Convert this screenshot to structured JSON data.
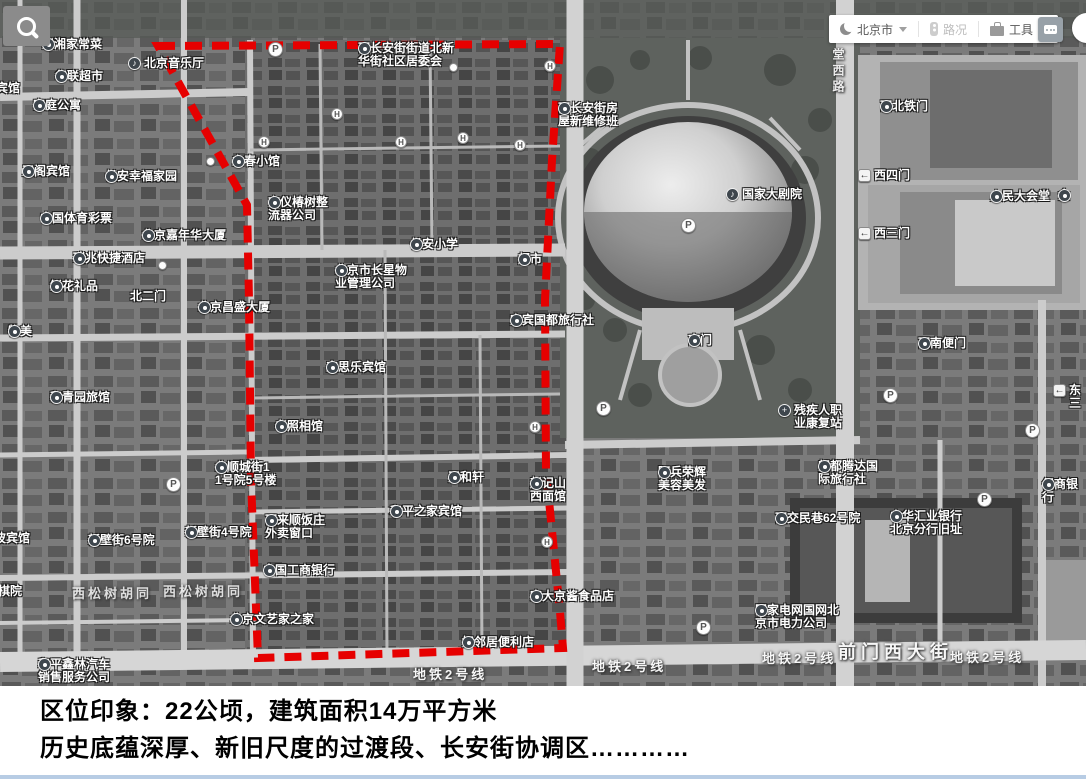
{
  "toolbar": {
    "city": "北京市",
    "traffic_label": "路况",
    "tools_label": "工具"
  },
  "caption": {
    "line1": "区位印象：22公顷，建筑面积14万平方米",
    "line2": "历史底蕴深厚、新旧尺度的过渡段、长安街协调区…………"
  },
  "map": {
    "boundary_color": "#e60000",
    "poi_labels": [
      {
        "text": "川湘家常菜",
        "x": 42,
        "y": 38,
        "icon": "poi"
      },
      {
        "text": "北京音乐厅",
        "x": 128,
        "y": 57,
        "icon": "music"
      },
      {
        "text": "华联超市",
        "x": 55,
        "y": 70,
        "icon": "poi"
      },
      {
        "text": "苑宾馆",
        "x": -16,
        "y": 82,
        "icon": "poi"
      },
      {
        "text": "家庭公寓",
        "x": 33,
        "y": 99,
        "icon": "poi"
      },
      {
        "text": "玉阁宾馆",
        "x": 22,
        "y": 165,
        "icon": "poi"
      },
      {
        "text": "长安幸福家园",
        "x": 105,
        "y": 170,
        "icon": "poi"
      },
      {
        "text": "中国体育彩票",
        "x": 40,
        "y": 212,
        "icon": "poi"
      },
      {
        "text": "北京嘉年华大厦",
        "x": 142,
        "y": 229,
        "icon": "poi"
      },
      {
        "text": "瑞兆快捷酒店",
        "x": 73,
        "y": 252,
        "icon": "poi"
      },
      {
        "text": "鲜花礼品",
        "x": 50,
        "y": 280,
        "icon": "poi"
      },
      {
        "text": "北二门",
        "x": 130,
        "y": 290,
        "icon": "none"
      },
      {
        "text": "北京昌盛大厦",
        "x": 198,
        "y": 301,
        "icon": "poi"
      },
      {
        "text": "物美",
        "x": 8,
        "y": 325,
        "icon": "poi"
      },
      {
        "text": "和青园旅馆",
        "x": 50,
        "y": 391,
        "icon": "poi"
      },
      {
        "text": "北顺城街1\n1号院5号楼",
        "x": 215,
        "y": 461,
        "icon": "poi"
      },
      {
        "text": "宁波宾馆",
        "x": -18,
        "y": 532,
        "icon": "none"
      },
      {
        "text": "新壁街6号院",
        "x": 88,
        "y": 534,
        "icon": "poi"
      },
      {
        "text": "新壁街4号院",
        "x": 185,
        "y": 526,
        "icon": "poi"
      },
      {
        "text": "京棋院",
        "x": -14,
        "y": 585,
        "icon": "none"
      },
      {
        "text": "和平鑫林汽车\n销售服务公司",
        "x": 38,
        "y": 658,
        "icon": "poi"
      },
      {
        "text": "西长安街街道北新\n华街社区居委会",
        "x": 358,
        "y": 42,
        "icon": "poi"
      },
      {
        "text": "立春小馆",
        "x": 232,
        "y": 155,
        "icon": "poi"
      },
      {
        "text": "京仪椿树整\n流器公司",
        "x": 268,
        "y": 196,
        "icon": "poi"
      },
      {
        "text": "北京市长星物\n业管理公司",
        "x": 335,
        "y": 264,
        "icon": "poi"
      },
      {
        "text": "长安小学",
        "x": 410,
        "y": 238,
        "icon": "poi"
      },
      {
        "text": "超市",
        "x": 518,
        "y": 253,
        "icon": "poi"
      },
      {
        "text": "宜宾国都旅行社",
        "x": 510,
        "y": 314,
        "icon": "poi"
      },
      {
        "text": "来思乐宾馆",
        "x": 326,
        "y": 361,
        "icon": "poi"
      },
      {
        "text": "老照相馆",
        "x": 275,
        "y": 420,
        "icon": "poi"
      },
      {
        "text": "天和轩",
        "x": 448,
        "y": 471,
        "icon": "poi"
      },
      {
        "text": "赵记山\n西面馆",
        "x": 530,
        "y": 477,
        "icon": "poi"
      },
      {
        "text": "和平之家宾馆",
        "x": 390,
        "y": 505,
        "icon": "poi"
      },
      {
        "text": "西来顺饭庄\n外卖窗口",
        "x": 265,
        "y": 514,
        "icon": "poi"
      },
      {
        "text": "中国工商银行",
        "x": 263,
        "y": 564,
        "icon": "poi"
      },
      {
        "text": "北京文艺家之家",
        "x": 230,
        "y": 613,
        "icon": "poi"
      },
      {
        "text": "宏大京酱食品店",
        "x": 530,
        "y": 590,
        "icon": "poi"
      },
      {
        "text": "好邻居便利店",
        "x": 462,
        "y": 636,
        "icon": "poi"
      },
      {
        "text": "西长安街房\n屋新维修班",
        "x": 558,
        "y": 102,
        "icon": "poi"
      },
      {
        "text": "国家大剧院",
        "x": 726,
        "y": 188,
        "icon": "music"
      },
      {
        "text": "南门",
        "x": 688,
        "y": 334,
        "icon": "poi"
      },
      {
        "text": "残疾人职\n业康复站",
        "x": 778,
        "y": 404,
        "icon": "cross"
      },
      {
        "text": "阿兵荣辉\n美容美发",
        "x": 658,
        "y": 466,
        "icon": "poi"
      },
      {
        "text": "朗都腾达国\n际旅行社",
        "x": 818,
        "y": 460,
        "icon": "poi"
      },
      {
        "text": "西交民巷62号院",
        "x": 775,
        "y": 512,
        "icon": "poi"
      },
      {
        "text": "国家电网国网北\n京市电力公司",
        "x": 755,
        "y": 604,
        "icon": "poi"
      },
      {
        "text": "中华汇业银行\n北京分行旧址",
        "x": 890,
        "y": 510,
        "icon": "poi"
      },
      {
        "text": "保商银行",
        "x": 1042,
        "y": 478,
        "icon": "poi"
      },
      {
        "text": "西北铁门",
        "x": 880,
        "y": 100,
        "icon": "poi"
      },
      {
        "text": "西四门",
        "x": 858,
        "y": 169,
        "icon": "arrow"
      },
      {
        "text": "人民大会堂",
        "x": 990,
        "y": 190,
        "icon": "poi"
      },
      {
        "text": "金",
        "x": 1058,
        "y": 189,
        "icon": "poi"
      },
      {
        "text": "西三门",
        "x": 858,
        "y": 227,
        "icon": "arrow"
      },
      {
        "text": "西南便门",
        "x": 918,
        "y": 337,
        "icon": "poi"
      },
      {
        "text": "东三",
        "x": 1053,
        "y": 384,
        "icon": "arrow"
      }
    ],
    "street_labels": [
      {
        "text": "西松树胡同",
        "x": 72,
        "y": 583,
        "cls": "hutong"
      },
      {
        "text": "西松树胡同",
        "x": 163,
        "y": 581,
        "cls": "hutong"
      },
      {
        "text": "地铁2号线",
        "x": 413,
        "y": 664,
        "cls": "metro"
      },
      {
        "text": "地铁2号线",
        "x": 592,
        "y": 656,
        "cls": "metro"
      },
      {
        "text": "地铁2号线",
        "x": 762,
        "y": 648,
        "cls": "metro"
      },
      {
        "text": "地铁2号线",
        "x": 950,
        "y": 647,
        "cls": "metro"
      },
      {
        "text": "前门西大街",
        "x": 838,
        "y": 638,
        "cls": "avenue"
      },
      {
        "text": "堂西路",
        "x": 830,
        "y": 48,
        "cls": "vertical"
      }
    ],
    "parking_markers": [
      [
        268,
        42
      ],
      [
        681,
        218
      ],
      [
        596,
        401
      ],
      [
        883,
        388
      ],
      [
        1025,
        423
      ],
      [
        977,
        492
      ],
      [
        166,
        477
      ],
      [
        696,
        620
      ]
    ],
    "hotel_markers": [
      [
        331,
        108
      ],
      [
        258,
        136
      ],
      [
        395,
        136
      ],
      [
        457,
        132
      ],
      [
        514,
        139
      ],
      [
        544,
        60
      ],
      [
        529,
        421
      ],
      [
        541,
        536
      ]
    ],
    "stop_markers": [
      [
        206,
        157
      ],
      [
        158,
        261
      ],
      [
        449,
        63
      ]
    ]
  }
}
